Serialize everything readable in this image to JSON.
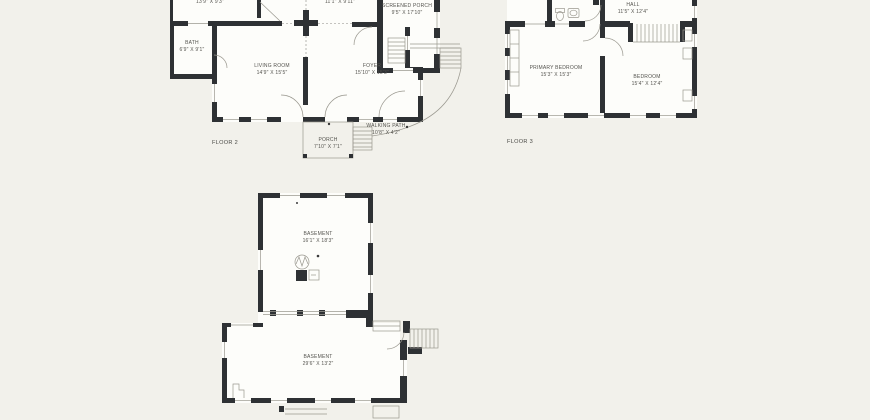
{
  "colors": {
    "background": "#f2f1eb",
    "wall": "#2e3134",
    "room": "#fdfdfa",
    "line": "#9a988f",
    "text": "#54534e"
  },
  "floor2": {
    "label": "FLOOR 2",
    "rooms": {
      "top_left": {
        "dims": "13'9\" X 9'3\""
      },
      "top_mid": {
        "dims": "11'1\" X 9'11\""
      },
      "screened_porch": {
        "name": "SCREENED PORCH",
        "dims": "9'5\" X 17'10\""
      },
      "bath": {
        "name": "BATH",
        "dims": "6'9\" X 9'1\""
      },
      "living_room": {
        "name": "LIVING ROOM",
        "dims": "14'9\" X 15'5\""
      },
      "foyer": {
        "name": "FOYER",
        "dims": "15'10\" X 15'3\""
      },
      "porch": {
        "name": "PORCH",
        "dims": "7'10\" X 7'1\""
      },
      "walking_path": {
        "name": "WALKING PATH",
        "dims": "10'8\" X 4'2\""
      }
    }
  },
  "floor3": {
    "label": "FLOOR 3",
    "rooms": {
      "hall": {
        "name": "HALL",
        "dims": "11'5\" X 12'4\""
      },
      "primary_bedroom": {
        "name": "PRIMARY BEDROOM",
        "dims": "15'3\" X 15'3\""
      },
      "bedroom": {
        "name": "BEDROOM",
        "dims": "15'4\" X 12'4\""
      }
    }
  },
  "basement": {
    "rooms": {
      "upper": {
        "name": "BASEMENT",
        "dims": "16'1\" X 18'3\""
      },
      "lower": {
        "name": "BASEMENT",
        "dims": "29'6\" X 13'2\""
      }
    }
  }
}
